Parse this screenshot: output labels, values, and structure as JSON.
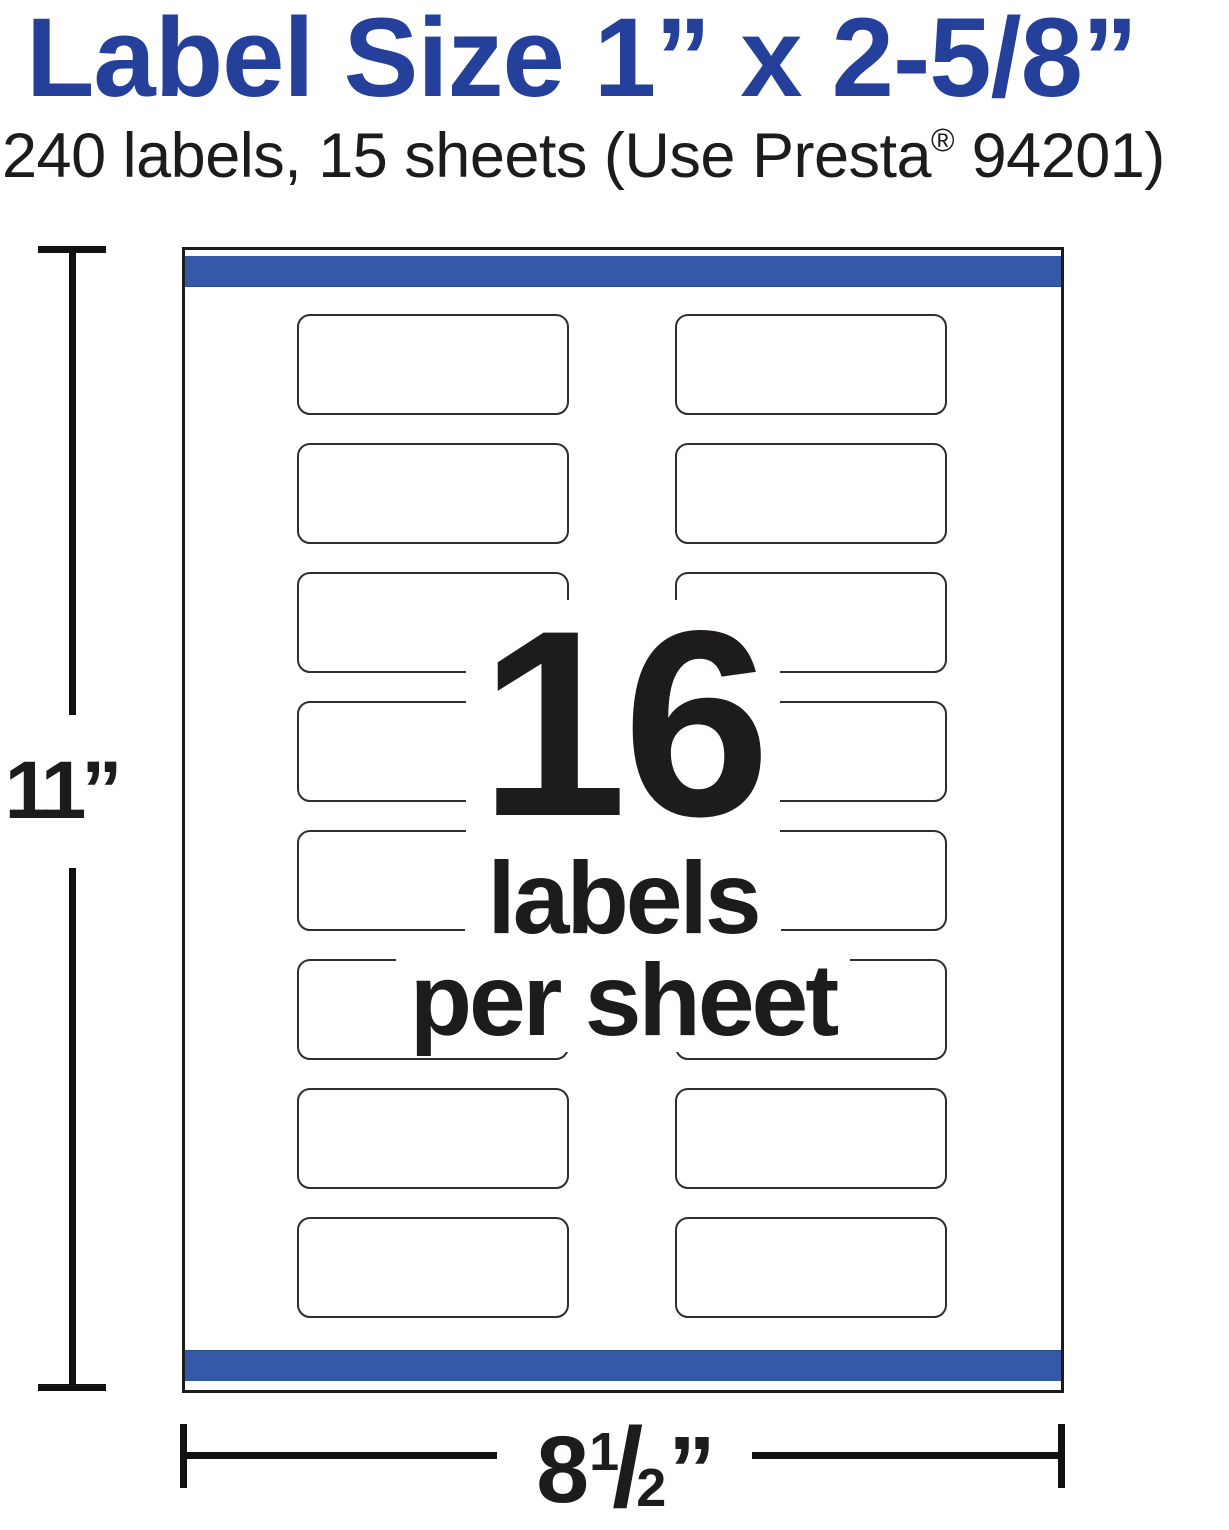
{
  "header": {
    "title": "Label Size 1” x 2-5/8”",
    "subtitle": {
      "prefix": "240 labels, 15 sheets (Use Presta",
      "registered_mark": "®",
      "suffix": " 94201)"
    }
  },
  "sheet": {
    "rows": 8,
    "columns": 2,
    "overlay": {
      "count": "16",
      "unit_line": "labels",
      "per_line": "per sheet"
    }
  },
  "dimensions": {
    "height": "11”",
    "width": {
      "whole": "8",
      "numerator": "1",
      "slash": "/",
      "denominator": "2",
      "inch_mark": "”"
    }
  },
  "colors": {
    "brand_blue": "#24409A",
    "stripe_blue": "#3558A8",
    "ink": "#1E1B1C"
  }
}
